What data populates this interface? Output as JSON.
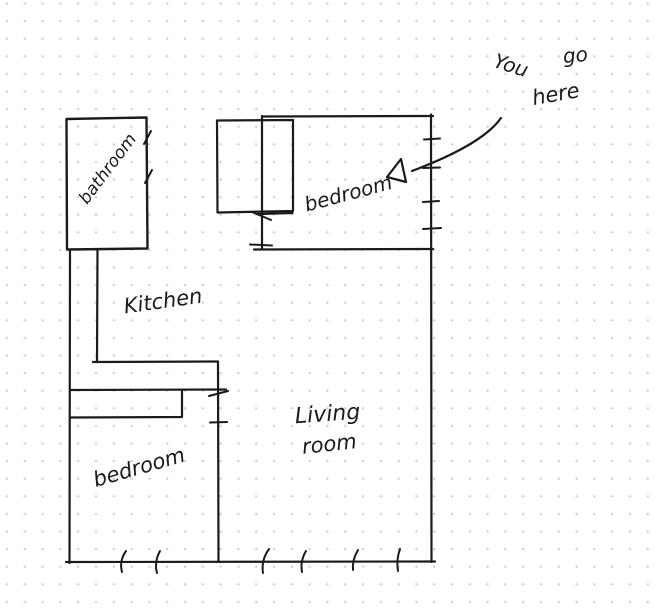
{
  "colors": {
    "ink": "#1b1b1b",
    "dots": "#cccccc",
    "background": "#ffffff"
  },
  "rooms": {
    "bathroom": {
      "label": "bathroom"
    },
    "kitchen": {
      "label": "Kitchen"
    },
    "bedroom_top": {
      "label": "bedroom"
    },
    "bedroom_bottom": {
      "label": "bedroom"
    },
    "living_room": {
      "label": "Living room",
      "line1": "Living",
      "line2": "room"
    }
  },
  "annotation": {
    "text": "You go here",
    "words": [
      "You",
      "go",
      "here"
    ]
  }
}
